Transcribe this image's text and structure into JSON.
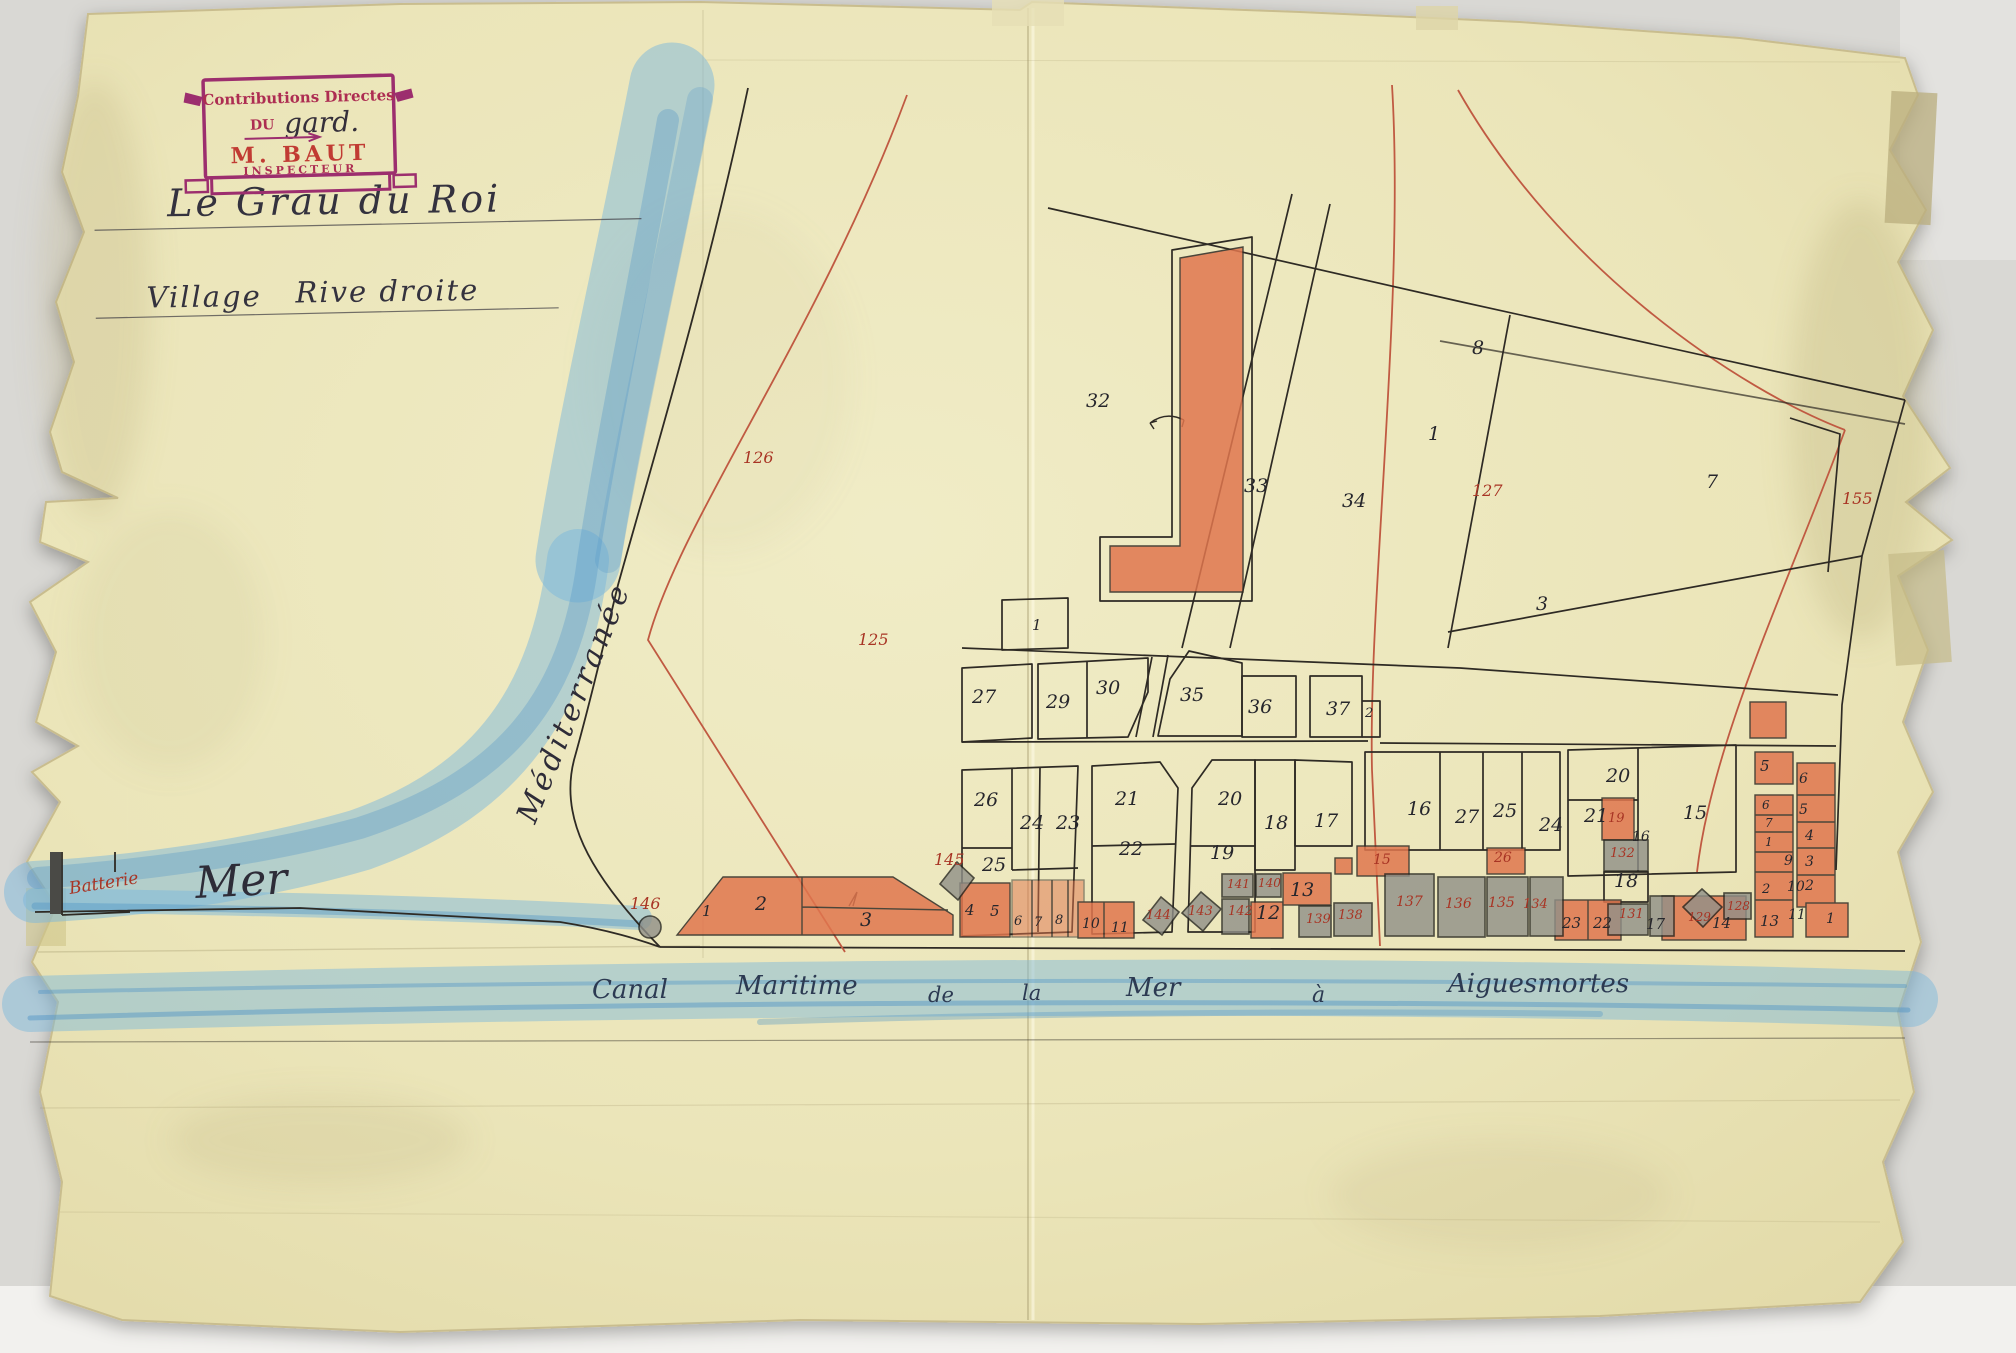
{
  "stamp": {
    "line1": "Contributions Directes",
    "du": "DU",
    "handwritten": "gard.",
    "name": "M. BAUT",
    "role": "INSPECTEUR"
  },
  "titles": {
    "line1": "Le Grau du Roi",
    "village": "Village",
    "rive": "Rive droite"
  },
  "sea": {
    "mediterranee": "Méditerranée",
    "mer": "Mer",
    "batterie": "Batterie"
  },
  "canal": {
    "words": [
      {
        "t": "Canal",
        "x": 592,
        "y": 998,
        "s": 26
      },
      {
        "t": "Maritime",
        "x": 736,
        "y": 994,
        "s": 26
      },
      {
        "t": "de",
        "x": 928,
        "y": 1002,
        "s": 21
      },
      {
        "t": "la",
        "x": 1022,
        "y": 1000,
        "s": 21
      },
      {
        "t": "Mer",
        "x": 1126,
        "y": 996,
        "s": 26
      },
      {
        "t": "à",
        "x": 1312,
        "y": 1002,
        "s": 22
      },
      {
        "t": "Aiguesmortes",
        "x": 1448,
        "y": 992,
        "s": 26
      }
    ]
  },
  "labels": {
    "black": [
      {
        "t": "32",
        "x": 1086,
        "y": 407
      },
      {
        "t": "33",
        "x": 1244,
        "y": 492
      },
      {
        "t": "34",
        "x": 1342,
        "y": 507
      },
      {
        "t": "1",
        "x": 1428,
        "y": 440
      },
      {
        "t": "8",
        "x": 1472,
        "y": 354
      },
      {
        "t": "7",
        "x": 1706,
        "y": 488
      },
      {
        "t": "3",
        "x": 1536,
        "y": 610
      },
      {
        "t": "1",
        "x": 1032,
        "y": 630,
        "s": 15
      },
      {
        "t": "27",
        "x": 972,
        "y": 703
      },
      {
        "t": "29",
        "x": 1046,
        "y": 708
      },
      {
        "t": "30",
        "x": 1096,
        "y": 694
      },
      {
        "t": "35",
        "x": 1180,
        "y": 701
      },
      {
        "t": "36",
        "x": 1248,
        "y": 713
      },
      {
        "t": "37",
        "x": 1326,
        "y": 715
      },
      {
        "t": "2",
        "x": 1365,
        "y": 717,
        "s": 13
      },
      {
        "t": "26",
        "x": 974,
        "y": 806
      },
      {
        "t": "24",
        "x": 1020,
        "y": 829
      },
      {
        "t": "23",
        "x": 1056,
        "y": 829
      },
      {
        "t": "25",
        "x": 982,
        "y": 871
      },
      {
        "t": "21",
        "x": 1115,
        "y": 805
      },
      {
        "t": "22",
        "x": 1119,
        "y": 855
      },
      {
        "t": "20",
        "x": 1218,
        "y": 805
      },
      {
        "t": "19",
        "x": 1210,
        "y": 859
      },
      {
        "t": "18",
        "x": 1264,
        "y": 829
      },
      {
        "t": "17",
        "x": 1314,
        "y": 827
      },
      {
        "t": "16",
        "x": 1407,
        "y": 815
      },
      {
        "t": "27",
        "x": 1455,
        "y": 823
      },
      {
        "t": "25",
        "x": 1493,
        "y": 817
      },
      {
        "t": "24",
        "x": 1539,
        "y": 831
      },
      {
        "t": "20",
        "x": 1606,
        "y": 782
      },
      {
        "t": "21",
        "x": 1584,
        "y": 822
      },
      {
        "t": "16",
        "x": 1632,
        "y": 841,
        "s": 14
      },
      {
        "t": "15",
        "x": 1683,
        "y": 819
      },
      {
        "t": "18",
        "x": 1614,
        "y": 887
      },
      {
        "t": "1",
        "x": 702,
        "y": 916,
        "s": 15
      },
      {
        "t": "2",
        "x": 755,
        "y": 910
      },
      {
        "t": "3",
        "x": 860,
        "y": 926
      },
      {
        "t": "4",
        "x": 965,
        "y": 915,
        "s": 15
      },
      {
        "t": "5",
        "x": 990,
        "y": 916,
        "s": 15
      },
      {
        "t": "6",
        "x": 1014,
        "y": 925,
        "s": 13
      },
      {
        "t": "7",
        "x": 1034,
        "y": 926,
        "s": 13
      },
      {
        "t": "8",
        "x": 1055,
        "y": 924,
        "s": 13
      },
      {
        "t": "10",
        "x": 1082,
        "y": 928,
        "s": 14
      },
      {
        "t": "11",
        "x": 1111,
        "y": 932,
        "s": 14
      },
      {
        "t": "12",
        "x": 1256,
        "y": 919
      },
      {
        "t": "13",
        "x": 1290,
        "y": 896
      },
      {
        "t": "23",
        "x": 1562,
        "y": 928,
        "s": 15
      },
      {
        "t": "22",
        "x": 1593,
        "y": 928,
        "s": 15
      },
      {
        "t": "17",
        "x": 1646,
        "y": 929,
        "s": 15
      },
      {
        "t": "14",
        "x": 1712,
        "y": 928,
        "s": 15
      },
      {
        "t": "13",
        "x": 1760,
        "y": 926,
        "s": 15
      },
      {
        "t": "11",
        "x": 1788,
        "y": 919,
        "s": 14
      },
      {
        "t": "10",
        "x": 1787,
        "y": 891,
        "s": 14
      },
      {
        "t": "9",
        "x": 1784,
        "y": 865,
        "s": 14
      },
      {
        "t": "2",
        "x": 1762,
        "y": 893,
        "s": 13
      },
      {
        "t": "5",
        "x": 1760,
        "y": 771,
        "s": 15
      },
      {
        "t": "6",
        "x": 1799,
        "y": 783,
        "s": 14
      },
      {
        "t": "5",
        "x": 1799,
        "y": 814,
        "s": 14
      },
      {
        "t": "4",
        "x": 1805,
        "y": 840,
        "s": 14
      },
      {
        "t": "3",
        "x": 1805,
        "y": 866,
        "s": 14
      },
      {
        "t": "2",
        "x": 1805,
        "y": 890,
        "s": 14
      },
      {
        "t": "1",
        "x": 1826,
        "y": 923,
        "s": 14
      },
      {
        "t": "6",
        "x": 1762,
        "y": 809,
        "s": 12
      },
      {
        "t": "7",
        "x": 1765,
        "y": 827,
        "s": 12
      },
      {
        "t": "1",
        "x": 1765,
        "y": 846,
        "s": 12
      }
    ],
    "red": [
      {
        "t": "126",
        "x": 743,
        "y": 463
      },
      {
        "t": "125",
        "x": 858,
        "y": 645
      },
      {
        "t": "127",
        "x": 1472,
        "y": 496
      },
      {
        "t": "155",
        "x": 1842,
        "y": 504
      },
      {
        "t": "146",
        "x": 630,
        "y": 909
      },
      {
        "t": "145",
        "x": 934,
        "y": 865
      },
      {
        "t": "144",
        "x": 1146,
        "y": 919,
        "s": 13
      },
      {
        "t": "143",
        "x": 1188,
        "y": 915,
        "s": 13
      },
      {
        "t": "142",
        "x": 1228,
        "y": 915,
        "s": 13
      },
      {
        "t": "141",
        "x": 1227,
        "y": 888,
        "s": 12
      },
      {
        "t": "140",
        "x": 1258,
        "y": 887,
        "s": 12
      },
      {
        "t": "139",
        "x": 1306,
        "y": 923,
        "s": 13
      },
      {
        "t": "138",
        "x": 1338,
        "y": 919,
        "s": 13
      },
      {
        "t": "15",
        "x": 1373,
        "y": 864,
        "s": 14
      },
      {
        "t": "26",
        "x": 1494,
        "y": 862,
        "s": 14
      },
      {
        "t": "137",
        "x": 1396,
        "y": 906,
        "s": 14
      },
      {
        "t": "136",
        "x": 1445,
        "y": 908,
        "s": 14
      },
      {
        "t": "135",
        "x": 1488,
        "y": 907,
        "s": 14
      },
      {
        "t": "134",
        "x": 1523,
        "y": 908,
        "s": 13
      },
      {
        "t": "19",
        "x": 1608,
        "y": 822,
        "s": 13
      },
      {
        "t": "132",
        "x": 1610,
        "y": 857,
        "s": 13
      },
      {
        "t": "131",
        "x": 1619,
        "y": 918,
        "s": 13
      },
      {
        "t": "129",
        "x": 1688,
        "y": 921,
        "s": 12
      },
      {
        "t": "128",
        "x": 1727,
        "y": 910,
        "s": 12
      }
    ]
  },
  "colors": {
    "red_ink": "#a83424",
    "black_ink": "#26262c",
    "building_red": "#e0764e",
    "building_grey": "#8f8f88",
    "sea_blue": "#7cb8dc",
    "sea_blue_dark": "#4e93c6",
    "red_line": "#c05a42",
    "stamp_purple": "#9c2e6e",
    "stamp_red": "#c13b33",
    "stamp_crimson": "#ad2d52",
    "ink_blue": "#2c3a52"
  }
}
